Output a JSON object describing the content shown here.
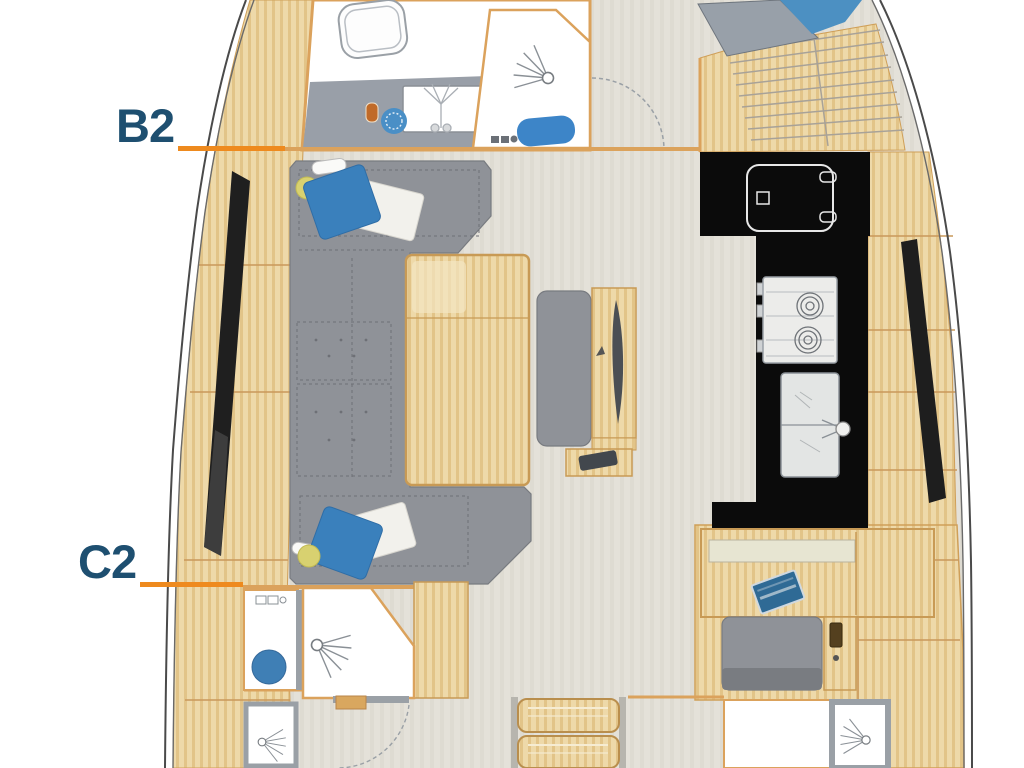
{
  "diagram": {
    "type": "yacht-interior-floor-plan",
    "labels": {
      "b2": "B2",
      "c2": "C2"
    },
    "colors": {
      "label_text": "#1e4f70",
      "leader_line": "#ee8a1e",
      "wall_trim": "#dba25c",
      "wood_fill": "#eed9a9",
      "floor_fill": "#e4e1d9",
      "upholstery_gray": "#8f9298",
      "galley_counter_black": "#0b0b0b",
      "accent_blue": "#3a80bc",
      "toilet_blue": "#3f7fb5",
      "hull_line": "#4a4a4a"
    },
    "fixtures": [
      "toilet",
      "vanity-sink",
      "faucet",
      "shower-head",
      "bath-mat",
      "l-shaped-sofa",
      "pillow",
      "blanket",
      "reading-lamp",
      "salon-table",
      "center-bench",
      "folding-leaf",
      "galley-fridge",
      "galley-stove",
      "galley-sink",
      "companionway-steps",
      "stair-treads",
      "nav-desk",
      "laptop",
      "nav-seat",
      "shower-stall",
      "hull-window",
      "door-swing"
    ]
  }
}
